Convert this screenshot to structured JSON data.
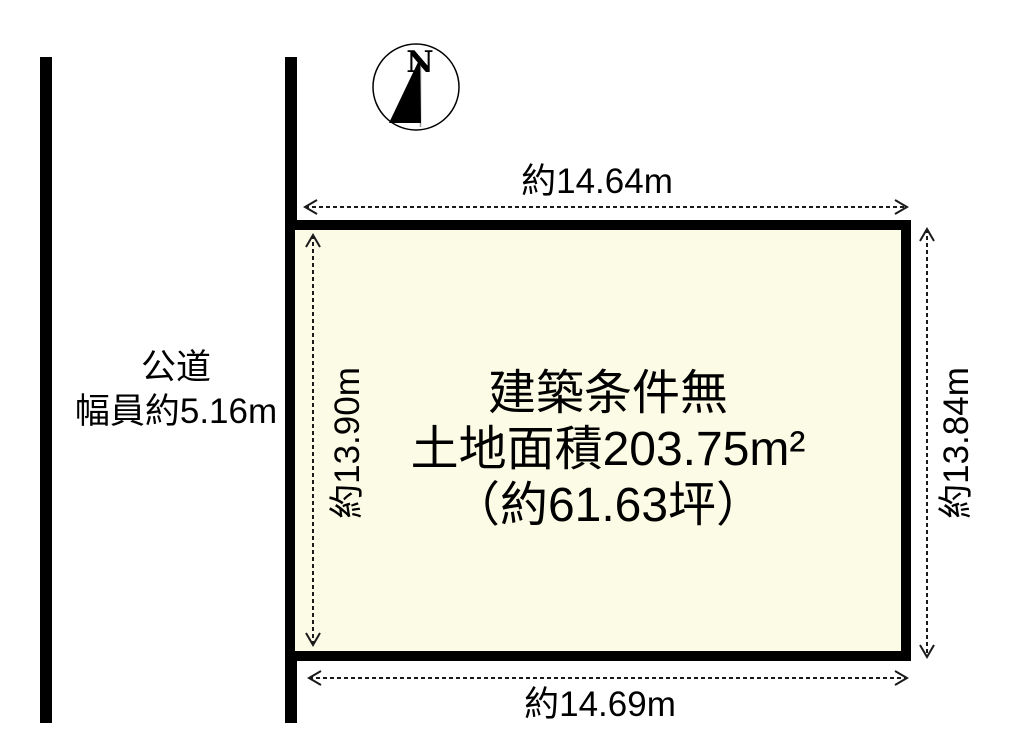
{
  "compass": {
    "north_label": "N"
  },
  "road": {
    "name": "公道",
    "width_label": "幅員約5.16m"
  },
  "plot": {
    "condition_label": "建築条件無",
    "area_label": "土地面積203.75m²",
    "tsubo_label": "（約61.63坪）",
    "fill_color": "#fcfce6",
    "border_color": "#000000"
  },
  "dimensions": {
    "top": "約14.64m",
    "bottom": "約14.69m",
    "left": "約13.90m",
    "right": "約13.84m"
  }
}
